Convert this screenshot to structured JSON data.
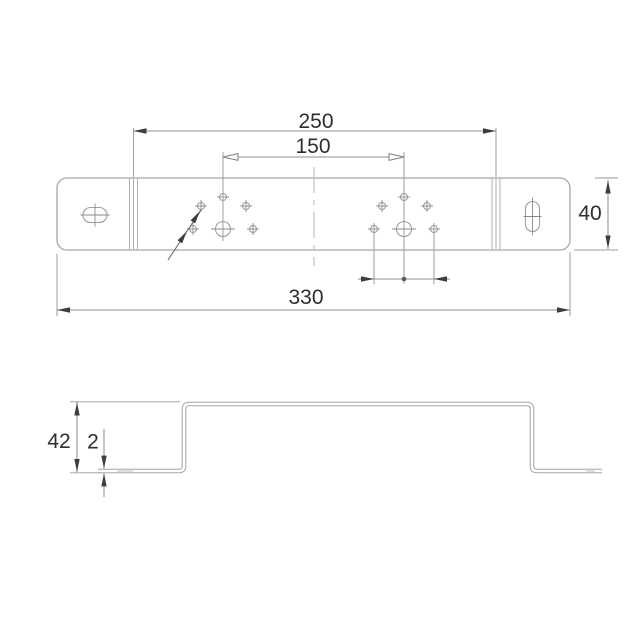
{
  "dimension_labels": {
    "fold_span": "250",
    "hole_pitch": "150",
    "overall_length": "330",
    "plate_width": "40",
    "profile_height": "42",
    "material_thickness": "2"
  },
  "colors": {
    "background": "#ffffff",
    "outline_gray": "#a6a6a6",
    "dimension_gray": "#8f8f8f",
    "arrow_dark": "#3d3d3d",
    "text_dark": "#2e2e2e"
  }
}
